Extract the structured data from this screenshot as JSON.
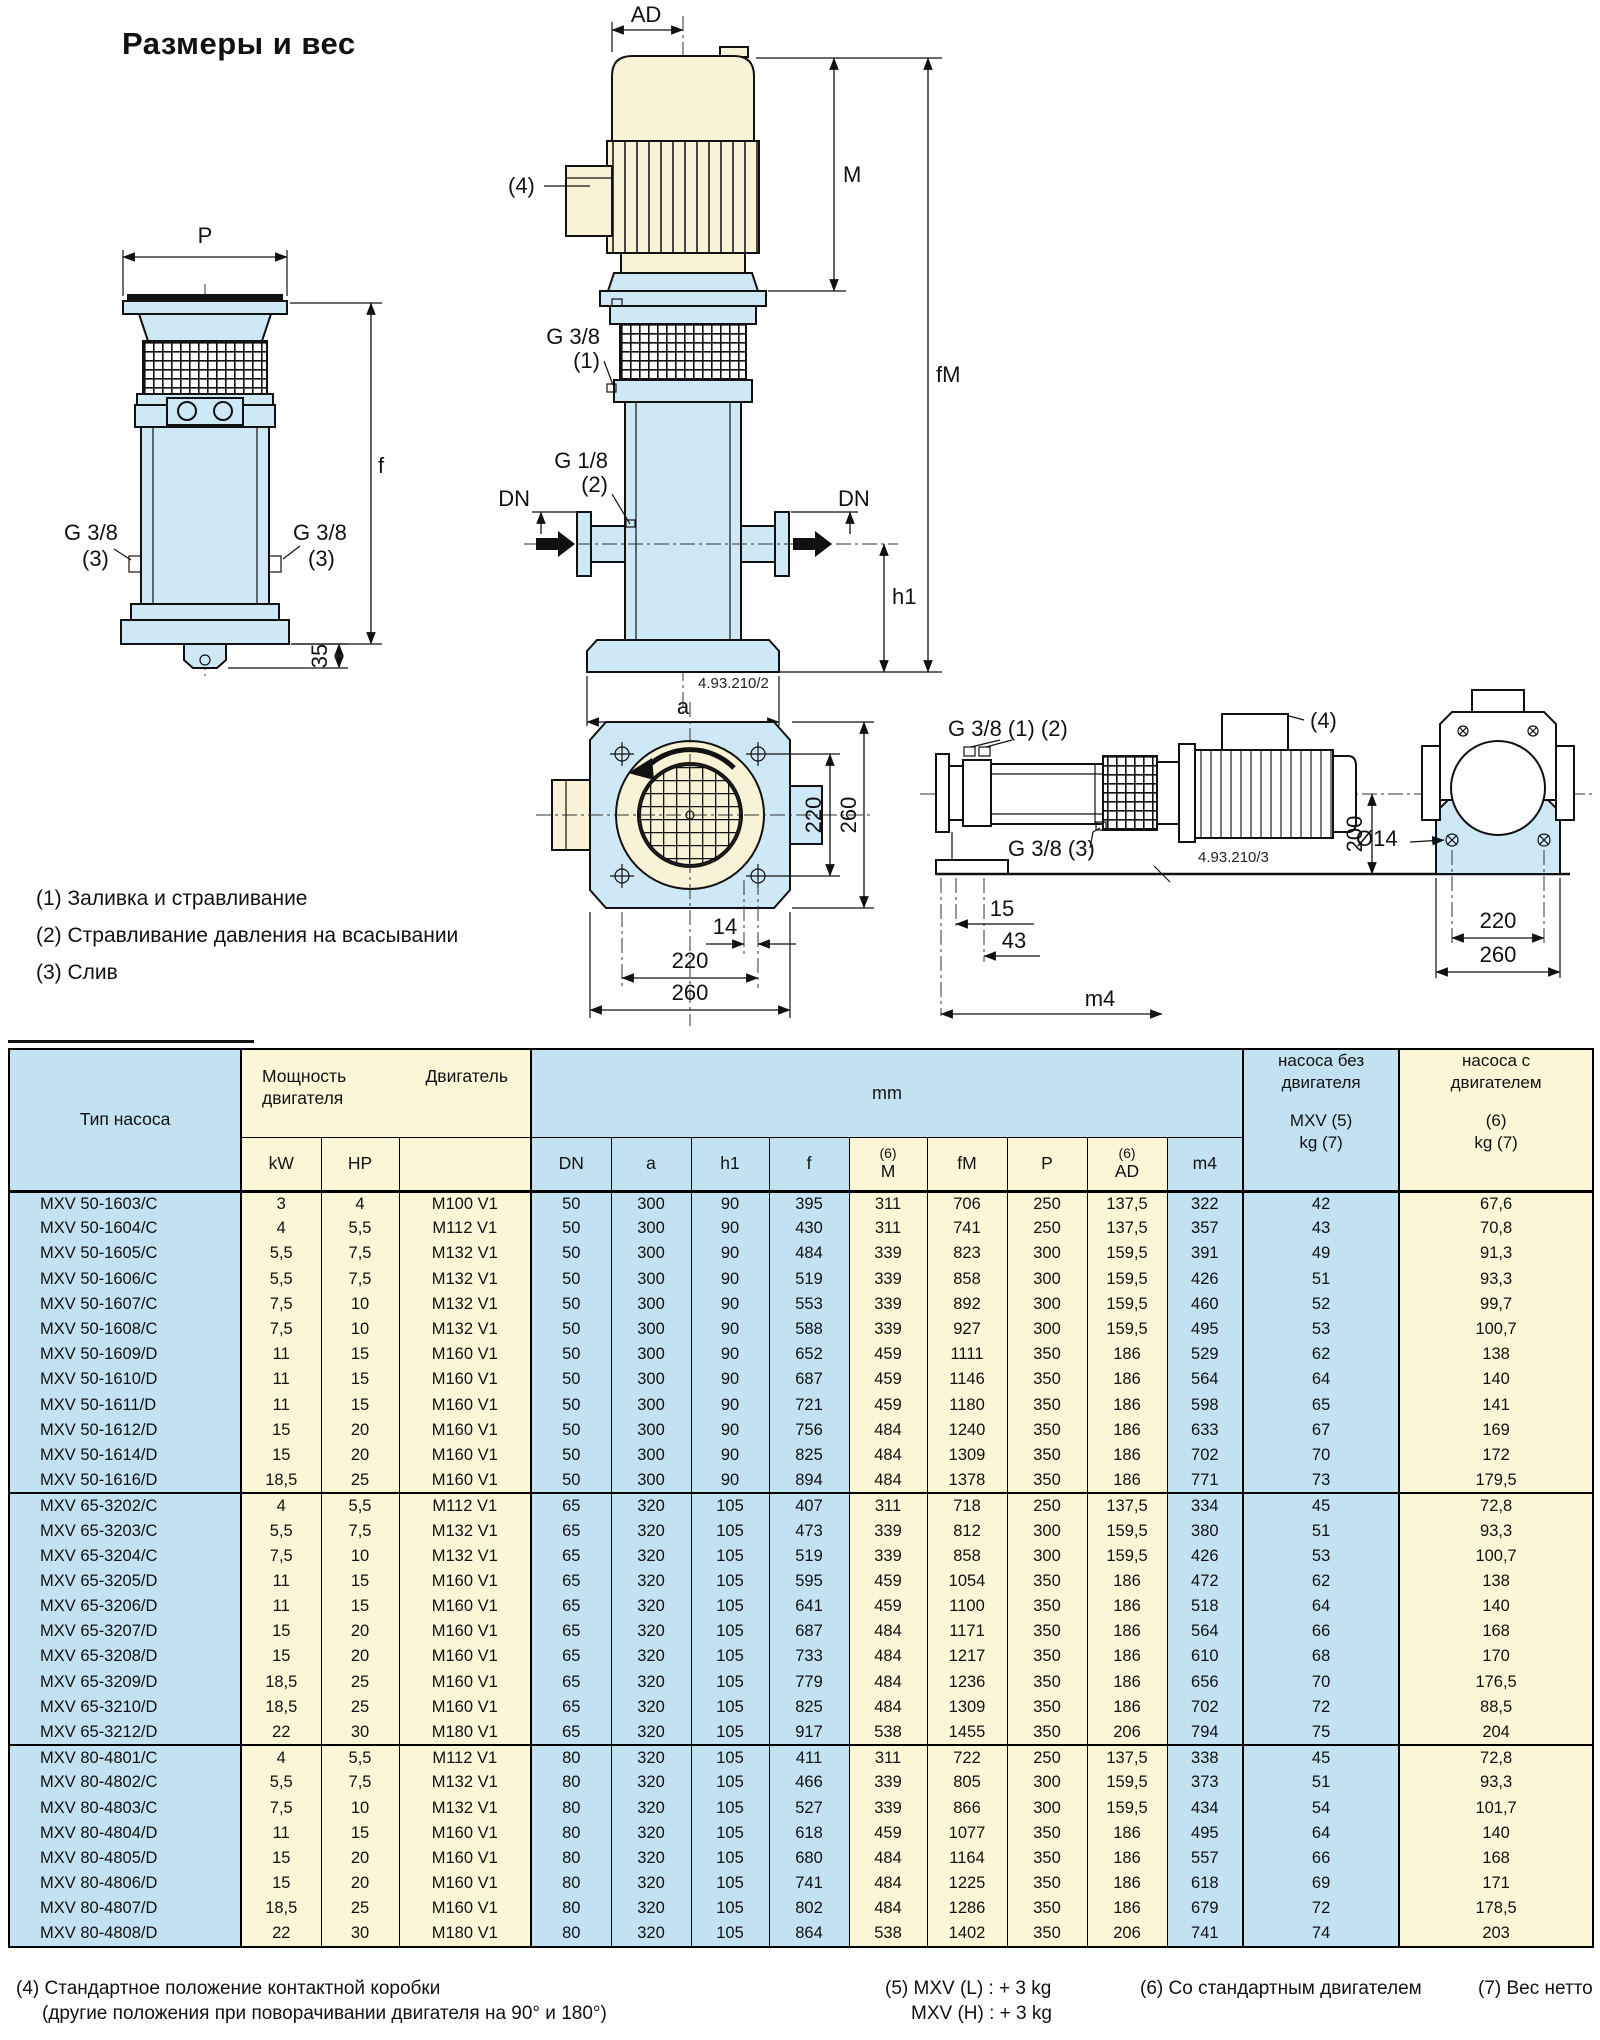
{
  "page": {
    "title": "Размеры и вес"
  },
  "colors": {
    "table_blue": "#c2e1f1",
    "table_yellow": "#faf6d6",
    "drawing_blue": "#cfe8f5",
    "drawing_cream": "#f8f3d6"
  },
  "drawing": {
    "labels": {
      "p": "P",
      "f": "f",
      "ad": "AD",
      "m": "M",
      "fm": "fM",
      "h1": "h1",
      "a": "a",
      "dn": "DN",
      "g38": "G 3/8",
      "g18": "G 1/8",
      "n1": "(1)",
      "n2": "(2)",
      "n3": "(3)",
      "n4": "(4)",
      "d35": "35",
      "d220": "220",
      "d260": "260",
      "d14": "14",
      "d15": "15",
      "d43": "43",
      "m4": "m4",
      "d200": "200",
      "dia14": "Ø14",
      "g38_12": "G 3/8 (1) (2)",
      "g38_3": "G 3/8 (3)",
      "code_front": "4.93.210/2",
      "code_side": "4.93.210/3"
    },
    "notes": [
      "(1) Заливка и стравливание",
      "(2) Стравливание давления на всасывании",
      "(3) Слив"
    ]
  },
  "table": {
    "header": {
      "type": "Тип насоса",
      "power_line1": "Мощность",
      "power_line2": "двигателя",
      "motor": "Двигатель",
      "kw": "kW",
      "hp": "HP",
      "mm": "mm",
      "sup6": "(6)",
      "dn": "DN",
      "a": "a",
      "h1": "h1",
      "f": "f",
      "m": "M",
      "fm": "fM",
      "p": "P",
      "ad": "AD",
      "m4": "m4",
      "kg1_line1": "насоса без",
      "kg1_line2": "двигателя",
      "kg1_line3": "MXV (5)",
      "kg1_line4": "kg (7)",
      "kg2_line1": "насоса с",
      "kg2_line2": "двигателем",
      "kg2_line3": "(6)",
      "kg2_line4": "kg (7)"
    },
    "groups": [
      {
        "rows": [
          [
            "MXV 50-1603/C",
            "3",
            "4",
            "M100 V1",
            "50",
            "300",
            "90",
            "395",
            "311",
            "706",
            "250",
            "137,5",
            "322",
            "42",
            "67,6"
          ],
          [
            "MXV 50-1604/C",
            "4",
            "5,5",
            "M112 V1",
            "50",
            "300",
            "90",
            "430",
            "311",
            "741",
            "250",
            "137,5",
            "357",
            "43",
            "70,8"
          ],
          [
            "MXV 50-1605/C",
            "5,5",
            "7,5",
            "M132 V1",
            "50",
            "300",
            "90",
            "484",
            "339",
            "823",
            "300",
            "159,5",
            "391",
            "49",
            "91,3"
          ],
          [
            "MXV 50-1606/C",
            "5,5",
            "7,5",
            "M132 V1",
            "50",
            "300",
            "90",
            "519",
            "339",
            "858",
            "300",
            "159,5",
            "426",
            "51",
            "93,3"
          ],
          [
            "MXV 50-1607/C",
            "7,5",
            "10",
            "M132 V1",
            "50",
            "300",
            "90",
            "553",
            "339",
            "892",
            "300",
            "159,5",
            "460",
            "52",
            "99,7"
          ],
          [
            "MXV 50-1608/C",
            "7,5",
            "10",
            "M132 V1",
            "50",
            "300",
            "90",
            "588",
            "339",
            "927",
            "300",
            "159,5",
            "495",
            "53",
            "100,7"
          ],
          [
            "MXV 50-1609/D",
            "11",
            "15",
            "M160 V1",
            "50",
            "300",
            "90",
            "652",
            "459",
            "1111",
            "350",
            "186",
            "529",
            "62",
            "138"
          ],
          [
            "MXV 50-1610/D",
            "11",
            "15",
            "M160 V1",
            "50",
            "300",
            "90",
            "687",
            "459",
            "1146",
            "350",
            "186",
            "564",
            "64",
            "140"
          ],
          [
            "MXV 50-1611/D",
            "11",
            "15",
            "M160 V1",
            "50",
            "300",
            "90",
            "721",
            "459",
            "1180",
            "350",
            "186",
            "598",
            "65",
            "141"
          ],
          [
            "MXV 50-1612/D",
            "15",
            "20",
            "M160 V1",
            "50",
            "300",
            "90",
            "756",
            "484",
            "1240",
            "350",
            "186",
            "633",
            "67",
            "169"
          ],
          [
            "MXV 50-1614/D",
            "15",
            "20",
            "M160 V1",
            "50",
            "300",
            "90",
            "825",
            "484",
            "1309",
            "350",
            "186",
            "702",
            "70",
            "172"
          ],
          [
            "MXV 50-1616/D",
            "18,5",
            "25",
            "M160 V1",
            "50",
            "300",
            "90",
            "894",
            "484",
            "1378",
            "350",
            "186",
            "771",
            "73",
            "179,5"
          ]
        ]
      },
      {
        "rows": [
          [
            "MXV 65-3202/C",
            "4",
            "5,5",
            "M112 V1",
            "65",
            "320",
            "105",
            "407",
            "311",
            "718",
            "250",
            "137,5",
            "334",
            "45",
            "72,8"
          ],
          [
            "MXV 65-3203/C",
            "5,5",
            "7,5",
            "M132 V1",
            "65",
            "320",
            "105",
            "473",
            "339",
            "812",
            "300",
            "159,5",
            "380",
            "51",
            "93,3"
          ],
          [
            "MXV 65-3204/C",
            "7,5",
            "10",
            "M132 V1",
            "65",
            "320",
            "105",
            "519",
            "339",
            "858",
            "300",
            "159,5",
            "426",
            "53",
            "100,7"
          ],
          [
            "MXV 65-3205/D",
            "11",
            "15",
            "M160 V1",
            "65",
            "320",
            "105",
            "595",
            "459",
            "1054",
            "350",
            "186",
            "472",
            "62",
            "138"
          ],
          [
            "MXV 65-3206/D",
            "11",
            "15",
            "M160 V1",
            "65",
            "320",
            "105",
            "641",
            "459",
            "1100",
            "350",
            "186",
            "518",
            "64",
            "140"
          ],
          [
            "MXV 65-3207/D",
            "15",
            "20",
            "M160 V1",
            "65",
            "320",
            "105",
            "687",
            "484",
            "1171",
            "350",
            "186",
            "564",
            "66",
            "168"
          ],
          [
            "MXV 65-3208/D",
            "15",
            "20",
            "M160 V1",
            "65",
            "320",
            "105",
            "733",
            "484",
            "1217",
            "350",
            "186",
            "610",
            "68",
            "170"
          ],
          [
            "MXV 65-3209/D",
            "18,5",
            "25",
            "M160 V1",
            "65",
            "320",
            "105",
            "779",
            "484",
            "1236",
            "350",
            "186",
            "656",
            "70",
            "176,5"
          ],
          [
            "MXV 65-3210/D",
            "18,5",
            "25",
            "M160 V1",
            "65",
            "320",
            "105",
            "825",
            "484",
            "1309",
            "350",
            "186",
            "702",
            "72",
            "88,5"
          ],
          [
            "MXV 65-3212/D",
            "22",
            "30",
            "M180 V1",
            "65",
            "320",
            "105",
            "917",
            "538",
            "1455",
            "350",
            "206",
            "794",
            "75",
            "204"
          ]
        ]
      },
      {
        "rows": [
          [
            "MXV 80-4801/C",
            "4",
            "5,5",
            "M112 V1",
            "80",
            "320",
            "105",
            "411",
            "311",
            "722",
            "250",
            "137,5",
            "338",
            "45",
            "72,8"
          ],
          [
            "MXV 80-4802/C",
            "5,5",
            "7,5",
            "M132 V1",
            "80",
            "320",
            "105",
            "466",
            "339",
            "805",
            "300",
            "159,5",
            "373",
            "51",
            "93,3"
          ],
          [
            "MXV 80-4803/C",
            "7,5",
            "10",
            "M132 V1",
            "80",
            "320",
            "105",
            "527",
            "339",
            "866",
            "300",
            "159,5",
            "434",
            "54",
            "101,7"
          ],
          [
            "MXV 80-4804/D",
            "11",
            "15",
            "M160 V1",
            "80",
            "320",
            "105",
            "618",
            "459",
            "1077",
            "350",
            "186",
            "495",
            "64",
            "140"
          ],
          [
            "MXV 80-4805/D",
            "15",
            "20",
            "M160 V1",
            "80",
            "320",
            "105",
            "680",
            "484",
            "1164",
            "350",
            "186",
            "557",
            "66",
            "168"
          ],
          [
            "MXV 80-4806/D",
            "15",
            "20",
            "M160 V1",
            "80",
            "320",
            "105",
            "741",
            "484",
            "1225",
            "350",
            "186",
            "618",
            "69",
            "171"
          ],
          [
            "MXV 80-4807/D",
            "18,5",
            "25",
            "M160 V1",
            "80",
            "320",
            "105",
            "802",
            "484",
            "1286",
            "350",
            "186",
            "679",
            "72",
            "178,5"
          ],
          [
            "MXV 80-4808/D",
            "22",
            "30",
            "M180 V1",
            "80",
            "320",
            "105",
            "864",
            "538",
            "1402",
            "350",
            "206",
            "741",
            "74",
            "203"
          ]
        ]
      }
    ]
  },
  "footnotes": {
    "f4_line1": "(4) Стандартное положение контактной коробки",
    "f4_line2": "(другие положения при поворачивании двигателя на 90° и 180°)",
    "f5_line1": "(5) MXV (L) : + 3 kg",
    "f5_line2": "MXV (H) : + 3 kg",
    "f6": "(6) Со стандартным двигателем",
    "f7": "(7) Вес нетто"
  }
}
